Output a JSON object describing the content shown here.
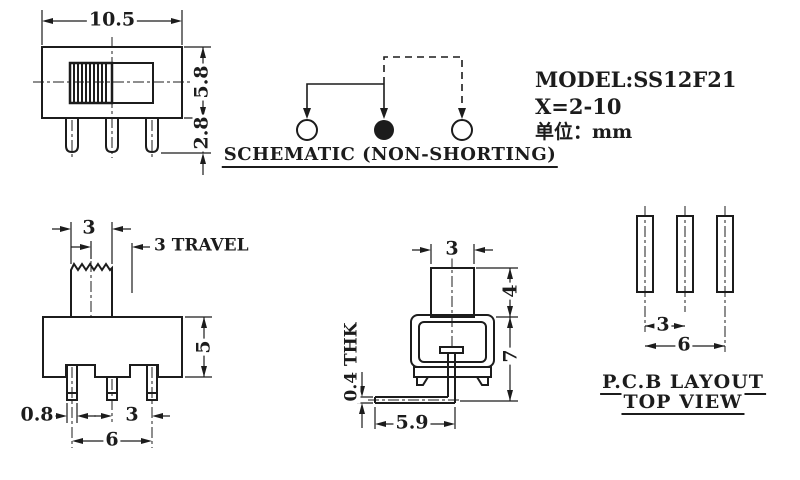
{
  "colors": {
    "line": "#1c1c1c",
    "background": "#ffffff"
  },
  "title_block": {
    "model": "MODEL:SS12F21",
    "variant": "X=2-10",
    "unit": "单位：mm"
  },
  "schematic": {
    "caption": "SCHEMATIC (NON-SHORTING)"
  },
  "front_view": {
    "width": "10.5",
    "height": "5.8",
    "pin_length": "2.8"
  },
  "side_view": {
    "knob_width": "3",
    "travel": "3 TRAVEL",
    "body_height": "5",
    "pin_width": "0.8",
    "pin_pitch": "3",
    "pin_span": "6"
  },
  "end_view": {
    "knob_width": "3",
    "knob_height": "4",
    "overall_height": "7",
    "lead_thickness": "0.4 THK",
    "lead_length": "5.9"
  },
  "pcb_layout": {
    "hole_pitch": "3",
    "hole_span": "6",
    "caption_line1": "P.C.B LAYOUT",
    "caption_line2": "TOP VIEW"
  }
}
